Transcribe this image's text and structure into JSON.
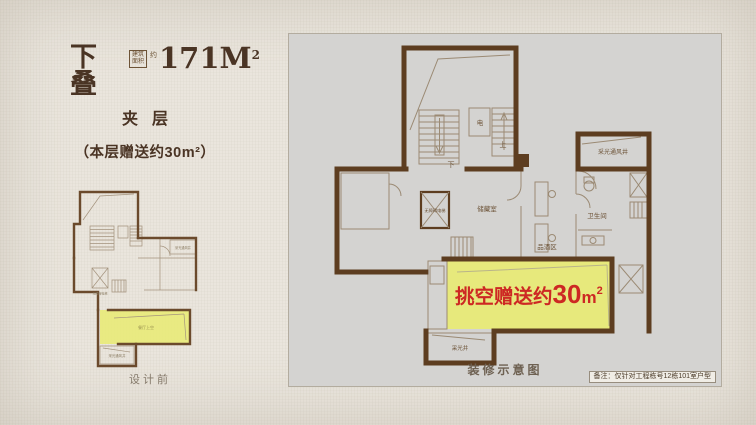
{
  "colors": {
    "paper": "#eae5dd",
    "panel_gray": "#d4d3d1",
    "wall_brown": "#5d3d20",
    "highlight_yellow": "#e9eb72",
    "highlight_red": "#cd2823"
  },
  "header": {
    "title": "下叠",
    "area_box_line1": "建筑",
    "area_box_line2": "面积",
    "area_approx": "约",
    "area_value": "171M",
    "area_sup": "2"
  },
  "left": {
    "floor_label": "夹层",
    "bonus_note": "（本层赠送约30m²）",
    "caption": "设计前",
    "plan": {
      "void_label": "餐厅上空",
      "vent_well": "采光通风井",
      "access_elevator": "无障碍电梯"
    }
  },
  "right": {
    "caption": "装修示意图",
    "note": "备注：仅针对工程栋号12栋101室户型",
    "highlight": {
      "prefix": "挑空赠送约",
      "value": "30",
      "unit": "m",
      "sup": "2"
    },
    "rooms": {
      "elevator": "电",
      "up": "上",
      "down": "下",
      "vent_well": "采光通风井",
      "bathroom": "卫生间",
      "storage": "储藏室",
      "wine_area": "品酒区",
      "access_elevator": "无障碍电梯",
      "light_well": "采光井"
    }
  }
}
